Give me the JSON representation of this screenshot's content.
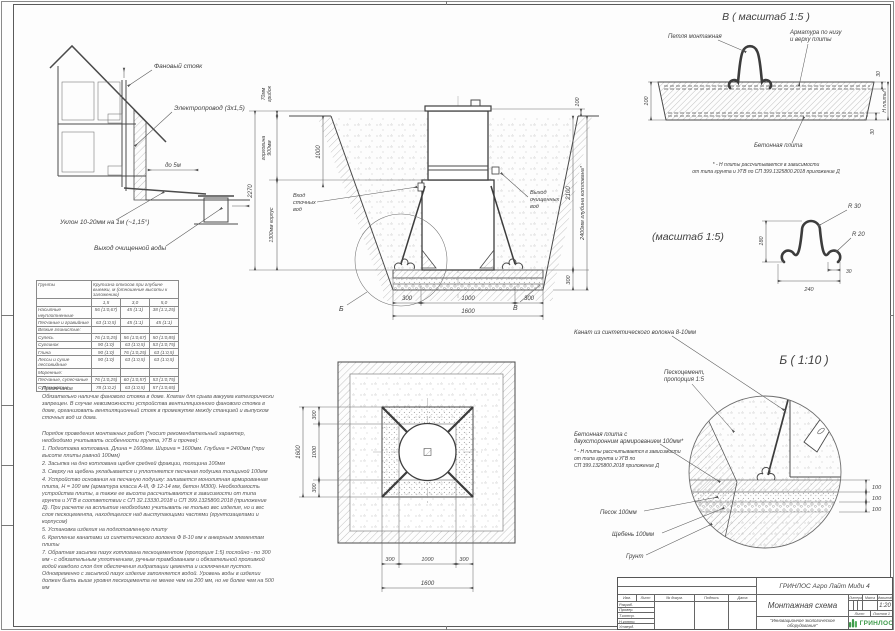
{
  "house": {
    "fan_stack": "Фановый стояк",
    "electric": "Электропровод (3х1,5)",
    "distance": "до 5м",
    "slope": "Уклон 10-20мм на 1м (~1,15°)",
    "outlet": "Выход очищенной воды"
  },
  "section": {
    "cap_l1": "70мм",
    "cap_l2": "грибок",
    "neck_l1": "горловина",
    "neck_l2": "900мм",
    "total": "2270",
    "body": "1300мм корпус",
    "inner1000": "1000",
    "inlet_l1": "Вход",
    "inlet_l2": "сточных",
    "inlet_l3": "вод",
    "outlet_l1": "Выход",
    "outlet_l2": "очищенных",
    "outlet_l3": "вод",
    "r100": "100",
    "r2100": "2100",
    "r300": "300",
    "depth": "2400мм глубина котлована*",
    "b300a": "300",
    "b1000": "1000",
    "b300b": "300",
    "b1600": "1600",
    "callout_b": "Б",
    "callout_v": "В"
  },
  "detail_v": {
    "title": "В ( масштаб 1:5 )",
    "loop": "Петля монтажная",
    "rebar_l1": "Арматура по низу",
    "rebar_l2": "и верху плиты",
    "plate": "Бетонная плита",
    "d100": "100",
    "d30t": "30",
    "d30b": "30",
    "dh": "Н плиты*",
    "note_l1": "* - Н плиты рассчитывается в зависимости",
    "note_l2": "от типа грунта и УГВ по СП 399.1325800.2018 приложение Д"
  },
  "detail_loop": {
    "title": "(масштаб 1:5)",
    "r30": "R 30",
    "r20": "R 20",
    "d180": "180",
    "d30": "30",
    "d240": "240"
  },
  "detail_b": {
    "title": "Б ( 1:10 )",
    "rope": "Канат из синтетического волокна 8-10мм",
    "sc_l1": "Пескоцемент,",
    "sc_l2": "пропорция 1:5",
    "plate_l1": "Бетонная плита с",
    "plate_l2": "двухсторонним армированием 100мм*",
    "note_l1": "* - Н плиты рассчитывается в зависимости",
    "note_l2": "от типа грунта и УГВ по",
    "note_l3": "СП 399.1325800.2018 приложение Д",
    "sand": "Песок 100мм",
    "gravel": "Щебень 100мм",
    "soil": "Грунт",
    "d100a": "100",
    "d100b": "100",
    "d100c": "100"
  },
  "plan": {
    "l300a": "300",
    "l1000": "1000",
    "l300b": "300",
    "l1600": "1600",
    "b300a": "300",
    "b1000": "1000",
    "b300b": "300",
    "b1600": "1600"
  },
  "soil_table": {
    "col_soil": "Грунты",
    "col_slope": "Крутизна откосов при глубине выемки, м (отношение высоты к заложению)",
    "d1": "1,5",
    "d2": "3,0",
    "d3": "5,0",
    "rows": [
      {
        "name": "Насыпные неуплотненные",
        "v1": "56 (1:0,67)",
        "v2": "45 (1:1)",
        "v3": "38 (1:1,25)"
      },
      {
        "name": "Песчаные и гравийные",
        "v1": "63 (1:0,5)",
        "v2": "45 (1:1)",
        "v3": "45 (1:1)"
      },
      {
        "name": "Вязкие глинистые:",
        "v1": "",
        "v2": "",
        "v3": ""
      },
      {
        "name": "Супесь",
        "v1": "76 (1:0,25)",
        "v2": "56 (1:0,67)",
        "v3": "50 (1:0,85)"
      },
      {
        "name": "Суглинок",
        "v1": "90 (1:0)",
        "v2": "63 (1:0,5)",
        "v3": "53 (1:0,75)"
      },
      {
        "name": "Глина",
        "v1": "90 (1:0)",
        "v2": "76 (1:0,25)",
        "v3": "63 (1:0,5)"
      },
      {
        "name": "Лессы и сухие лессовидные",
        "v1": "90 (1:0)",
        "v2": "63 (1:0,5)",
        "v3": "63 (1:0,5)"
      },
      {
        "name": "Моренные:",
        "v1": "",
        "v2": "",
        "v3": ""
      },
      {
        "name": "Песчаные, супесчаные",
        "v1": "76 (1:0,25)",
        "v2": "60 (1:0,57)",
        "v3": "53 (1:0,75)"
      },
      {
        "name": "Суглинистые",
        "v1": "78 (1:0,2)",
        "v2": "63 (1:0,5)",
        "v3": "57 (1:0,65)"
      }
    ]
  },
  "notes": {
    "heading": "Примечание",
    "p1": "Обязательно наличие фанового стояка в доме. Клапан для срыва вакуума категорически запрещен. В случае невозможности устройства вентиляционного фанового стояка в доме, организовать вентиляционный стояк в промежутке между станцией и выпуском сточных вод из дома.",
    "p2": "Порядок проведения монтажных работ (*носит рекомендательный характер, необходимо учитывать особенности грунта, УГВ и прочее):",
    "items": [
      "1. Подготовка котлована. Длина = 1600мм. Ширина = 1600мм. Глубина = 2400мм (*при высоте плиты равной 100мм)",
      "2. Засыпка на дно котлована щебня средней фракции, толщина 100мм",
      "3. Сверху на щебень укладывается и уплотняется песчаная подушка толщиной 100мм",
      "4. Устройство основания на песчаную подушку: заливается монолитная армированная плита, Н = 100 мм (арматура класса А-III, Ф 12-14 мм, бетон М300). Необходимость устройства плиты, а также ее высота рассчитываются в зависимости от типа грунта и УГВ в соответствии с СП 32.13330.2018 и СП 399.1325800.2018 (приложение Д). При расчете на всплытие необходимо учитывать не только вес изделия, но и вес слоя пескоцемента, находящегося над выступающими частями (грунтозацепами и корпусом)",
      "5. Установка изделия на подготовленную плиту",
      "6. Крепление канатами из синтетического волокна Ф 8-10 мм к анкерным элементам плиты",
      "7. Обратная засыпка пазух котлована пескоцементом (пропорция 1:5) послойно - по 300 мм - с обязательным уплотнением, ручным трамбованием и обязательной проливкой водой каждого слоя для обеспечения гидратации цемента и исключения пустот. Одновременно с засыпкой пазух изделие заполняется водой. Уровень воды в изделии должен быть выше уровня пескоцемента не менее чем на 200 мм, но не более чем на 500 мм"
    ]
  },
  "title_block": {
    "product": "ГРИНЛОС Агро Лайт Миди 4",
    "doc_title": "Монтажная схема",
    "tagline": "\"Инновационное экологическое оборудование\"",
    "brand": "ГРИНЛОС",
    "scale": "1:20",
    "litera": "Литера",
    "massa": "Масса",
    "masshtab": "Масштаб",
    "list_label": "Лист",
    "listov_label": "Листов 1",
    "col_izm": "Изм.",
    "col_list": "Лист",
    "col_doc": "№ докум.",
    "col_sign": "Подпись",
    "col_date": "Дата",
    "rows": [
      "Разраб.",
      "Провер.",
      "Т.контр.",
      "Н.контр.",
      "Утверд."
    ]
  }
}
